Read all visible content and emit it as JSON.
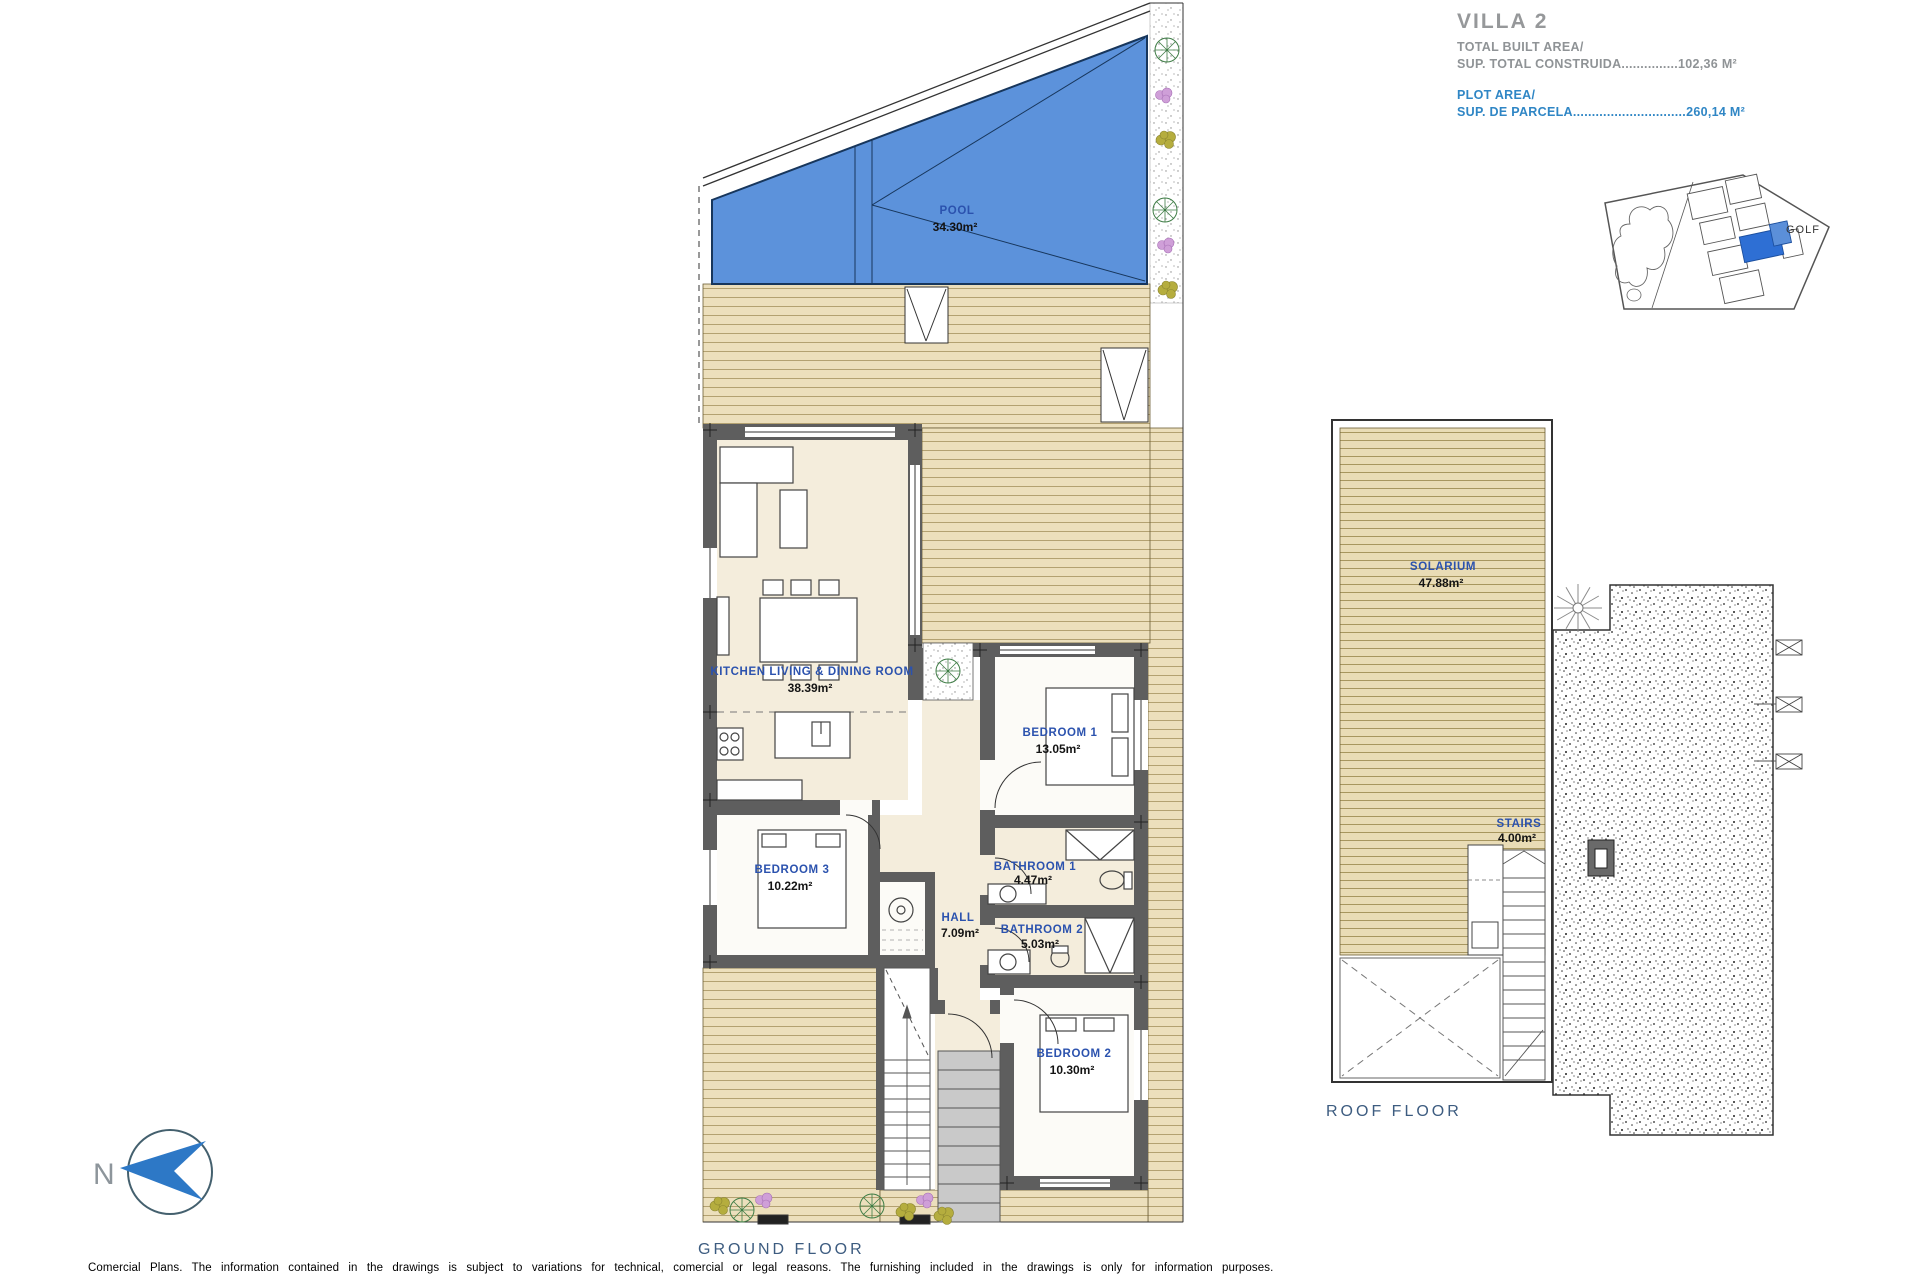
{
  "title_block": {
    "villa_name": "VILLA 2",
    "built_area": {
      "label_en": "TOTAL BUILT AREA/",
      "label_es": "SUP. TOTAL CONSTRUIDA",
      "leader": "...............",
      "value": "102,36 M²"
    },
    "plot_area": {
      "label_en": "PLOT AREA/",
      "label_es": "SUP. DE PARCELA",
      "leader": "..............................",
      "value": "260,14 M²"
    }
  },
  "site_plan": {
    "golf_label": "GOLF"
  },
  "ground_floor": {
    "caption": "GROUND FLOOR",
    "pool": {
      "name": "POOL",
      "area": "34.30m²"
    },
    "kitchen": {
      "name": "KITCHEN  LIVING  &  DINING   ROOM",
      "area": "38.39m²"
    },
    "bedroom1": {
      "name": "BEDROOM  1",
      "area": "13.05m²"
    },
    "bedroom2": {
      "name": "BEDROOM  2",
      "area": "10.30m²"
    },
    "bedroom3": {
      "name": "BEDROOM  3",
      "area": "10.22m²"
    },
    "bathroom1": {
      "name": "BATHROOM  1",
      "area": "4.47m²"
    },
    "bathroom2": {
      "name": "BATHROOM  2",
      "area": "5.03m²"
    },
    "hall": {
      "name": "HALL",
      "area": "7.09m²"
    }
  },
  "roof_floor": {
    "caption": "ROOF  FLOOR",
    "solarium": {
      "name": "SOLARIUM",
      "area": "47.88m²"
    },
    "stairs": {
      "name": "STAIRS",
      "area": "4.00m²"
    }
  },
  "compass": {
    "north_label": "N"
  },
  "footer": {
    "disclaimer": "Comercial Plans. The information contained in the drawings is subject to variations for technical, comercial or legal reasons. The furnishing included in the drawings is only for information purposes."
  },
  "colors": {
    "pool_blue": "#5c92db",
    "deck_tan": "#ecdfbc",
    "interior_cream": "#f4eddc",
    "wall_gray": "#5e5e5e",
    "label_blue": "#2b52ae",
    "title_gray": "#8f9396",
    "title_blue": "#2f86c5",
    "highlight_blue": "#2e6fd4"
  }
}
